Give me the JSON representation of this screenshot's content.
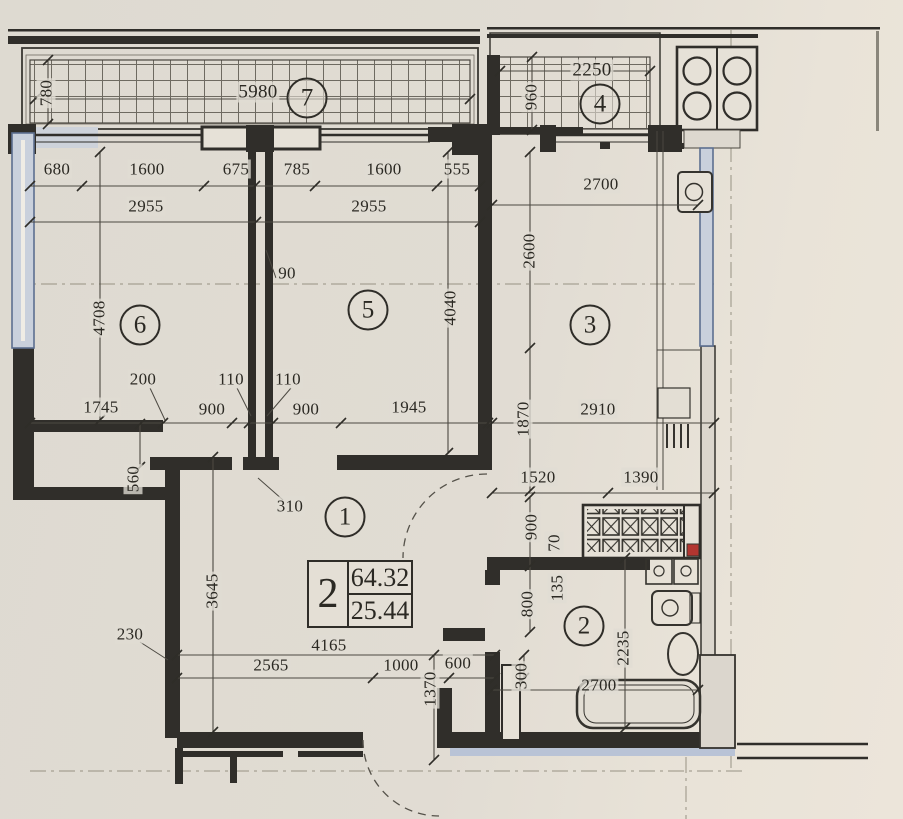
{
  "drawing": {
    "kind": "apartment floor plan",
    "units": "mm"
  },
  "colors": {
    "paper": "#e0dcd3",
    "ink": "#302e2a",
    "window_blue": "#c9d0dc",
    "window_border": "#5d6f90",
    "accent_red": "#b23530"
  },
  "rooms": {
    "hall": "1",
    "bathroom": "2",
    "kitchen": "3",
    "balcony_kitchen": "4",
    "living_room": "5",
    "bedroom": "6",
    "balcony_living": "7"
  },
  "area_table": {
    "rooms_count": "2",
    "total_area": "64.32",
    "living_area": "25.44"
  },
  "dims": {
    "b7_depth": "780",
    "b7_width": "5980",
    "b4_width": "2250",
    "b4_depth": "960",
    "t680": "680",
    "t1600a": "1600",
    "t675": "675",
    "t785": "785",
    "t1600b": "1600",
    "t555": "555",
    "r6w": "2955",
    "r5w": "2955",
    "k_top": "2700",
    "r6h": "4708",
    "p90": "90",
    "r5h": "4040",
    "k2600": "2600",
    "m200": "200",
    "m110a": "110",
    "m110b": "110",
    "m1745": "1745",
    "m900a": "900",
    "m900b": "900",
    "m1945": "1945",
    "k1870": "1870",
    "k2910": "2910",
    "s560": "560",
    "p310": "310",
    "h1520": "1520",
    "h1390": "1390",
    "h900": "900",
    "w70": "70",
    "h3645": "3645",
    "w230": "230",
    "b4165": "4165",
    "b2565": "2565",
    "b1000": "1000",
    "b600": "600",
    "v1370": "1370",
    "bt300": "300",
    "bt800": "800",
    "w135": "135",
    "bt2235": "2235",
    "bt2700": "2700"
  }
}
